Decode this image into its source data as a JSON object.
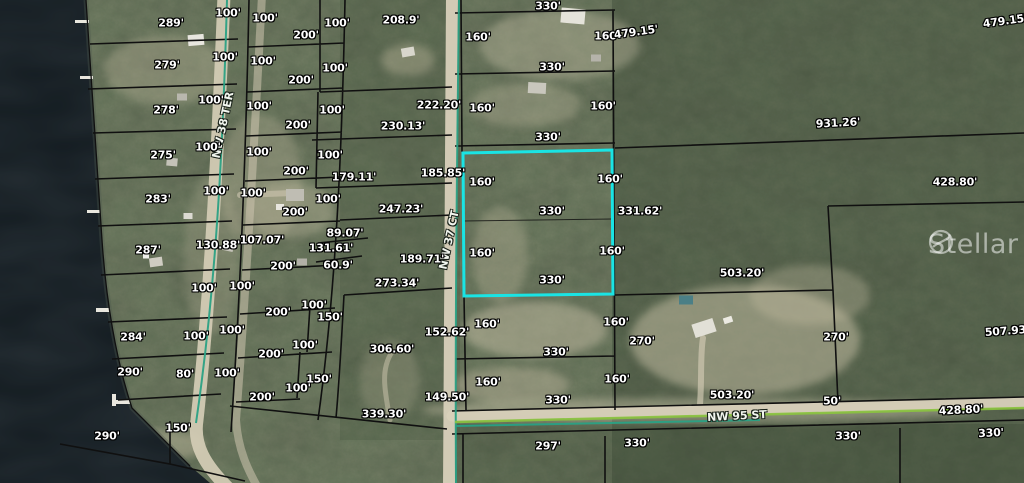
{
  "map": {
    "watermark": {
      "text": "Stellar MLS"
    },
    "subject_parcel": {
      "outline_color": "#1ae4e4",
      "frontage": "330'",
      "depth": "160'"
    },
    "colors": {
      "parcel_line": "#101010",
      "road_boundary_teal": "#2aa184",
      "street_line_green": "#8bc43f",
      "water": "#131b20",
      "dirt_road": "#d8d0ba",
      "highlight": "#1ae4e4"
    },
    "roads": [
      {
        "name": "NW 38 TER"
      },
      {
        "name": "NW 37 CT"
      },
      {
        "name": "NW 95 ST"
      }
    ],
    "road_labels": [
      {
        "t": "NW 38 TER",
        "x": 223,
        "y": 125,
        "r": -78
      },
      {
        "t": "NW 37 CT",
        "x": 449,
        "y": 240,
        "r": -78
      },
      {
        "t": "NW 95 ST",
        "x": 737,
        "y": 416,
        "r": -3
      }
    ],
    "dimension_labels": [
      {
        "t": "289'",
        "x": 171,
        "y": 23
      },
      {
        "t": "100'",
        "x": 228,
        "y": 13
      },
      {
        "t": "100'",
        "x": 265,
        "y": 18
      },
      {
        "t": "100'",
        "x": 337,
        "y": 23
      },
      {
        "t": "200'",
        "x": 306,
        "y": 35
      },
      {
        "t": "208.9'",
        "x": 401,
        "y": 20
      },
      {
        "t": "330'",
        "x": 548,
        "y": 6
      },
      {
        "t": "160'",
        "x": 478,
        "y": 37
      },
      {
        "t": "160'",
        "x": 607,
        "y": 36
      },
      {
        "t": "479.15'",
        "x": 636,
        "y": 32,
        "r": -8
      },
      {
        "t": "479.15'",
        "x": 1005,
        "y": 21,
        "r": -8
      },
      {
        "t": "279'",
        "x": 167,
        "y": 65
      },
      {
        "t": "100'",
        "x": 225,
        "y": 57
      },
      {
        "t": "100'",
        "x": 263,
        "y": 61
      },
      {
        "t": "100'",
        "x": 335,
        "y": 68
      },
      {
        "t": "200'",
        "x": 301,
        "y": 80
      },
      {
        "t": "330'",
        "x": 552,
        "y": 67
      },
      {
        "t": "278'",
        "x": 166,
        "y": 110
      },
      {
        "t": "100'",
        "x": 211,
        "y": 100
      },
      {
        "t": "100'",
        "x": 259,
        "y": 106
      },
      {
        "t": "100'",
        "x": 332,
        "y": 110
      },
      {
        "t": "200'",
        "x": 298,
        "y": 125
      },
      {
        "t": "222.20'",
        "x": 439,
        "y": 105
      },
      {
        "t": "230.13'",
        "x": 403,
        "y": 126
      },
      {
        "t": "160'",
        "x": 482,
        "y": 108
      },
      {
        "t": "160'",
        "x": 603,
        "y": 106
      },
      {
        "t": "330'",
        "x": 548,
        "y": 137
      },
      {
        "t": "931.26'",
        "x": 838,
        "y": 123,
        "r": -3
      },
      {
        "t": "275'",
        "x": 163,
        "y": 155
      },
      {
        "t": "100'",
        "x": 208,
        "y": 147
      },
      {
        "t": "100'",
        "x": 259,
        "y": 152
      },
      {
        "t": "100'",
        "x": 330,
        "y": 155
      },
      {
        "t": "200'",
        "x": 296,
        "y": 171
      },
      {
        "t": "179.11'",
        "x": 354,
        "y": 177
      },
      {
        "t": "185.85'",
        "x": 443,
        "y": 173
      },
      {
        "t": "160'",
        "x": 482,
        "y": 182
      },
      {
        "t": "160'",
        "x": 610,
        "y": 179
      },
      {
        "t": "283'",
        "x": 158,
        "y": 199
      },
      {
        "t": "100'",
        "x": 216,
        "y": 191
      },
      {
        "t": "100'",
        "x": 253,
        "y": 193
      },
      {
        "t": "100'",
        "x": 328,
        "y": 199
      },
      {
        "t": "200'",
        "x": 295,
        "y": 212
      },
      {
        "t": "247.23'",
        "x": 401,
        "y": 209
      },
      {
        "t": "330'",
        "x": 552,
        "y": 211
      },
      {
        "t": "331.62'",
        "x": 640,
        "y": 211
      },
      {
        "t": "428.80'",
        "x": 955,
        "y": 182
      },
      {
        "t": "287'",
        "x": 148,
        "y": 250
      },
      {
        "t": "130.88'",
        "x": 218,
        "y": 245
      },
      {
        "t": "107.07'",
        "x": 262,
        "y": 240
      },
      {
        "t": "89.07'",
        "x": 345,
        "y": 233
      },
      {
        "t": "131.61'",
        "x": 331,
        "y": 248
      },
      {
        "t": "60.9'",
        "x": 338,
        "y": 265
      },
      {
        "t": "200'",
        "x": 283,
        "y": 266
      },
      {
        "t": "189.71'",
        "x": 422,
        "y": 259
      },
      {
        "t": "160'",
        "x": 482,
        "y": 253
      },
      {
        "t": "160'",
        "x": 612,
        "y": 251
      },
      {
        "t": "330'",
        "x": 552,
        "y": 280
      },
      {
        "t": "503.20'",
        "x": 742,
        "y": 273
      },
      {
        "t": "273.34'",
        "x": 397,
        "y": 283
      },
      {
        "t": "100'",
        "x": 242,
        "y": 286
      },
      {
        "t": "100'",
        "x": 204,
        "y": 288
      },
      {
        "t": "284'",
        "x": 133,
        "y": 337
      },
      {
        "t": "100'",
        "x": 196,
        "y": 336
      },
      {
        "t": "100'",
        "x": 232,
        "y": 330
      },
      {
        "t": "200'",
        "x": 278,
        "y": 312
      },
      {
        "t": "100'",
        "x": 314,
        "y": 305
      },
      {
        "t": "150'",
        "x": 330,
        "y": 317
      },
      {
        "t": "306.60'",
        "x": 392,
        "y": 349
      },
      {
        "t": "152.62'",
        "x": 447,
        "y": 332
      },
      {
        "t": "160'",
        "x": 487,
        "y": 324
      },
      {
        "t": "160'",
        "x": 616,
        "y": 322
      },
      {
        "t": "270'",
        "x": 642,
        "y": 341
      },
      {
        "t": "270'",
        "x": 836,
        "y": 337
      },
      {
        "t": "507.93'",
        "x": 1007,
        "y": 331,
        "r": -4
      },
      {
        "t": "330'",
        "x": 556,
        "y": 352
      },
      {
        "t": "290'",
        "x": 130,
        "y": 372
      },
      {
        "t": "80'",
        "x": 185,
        "y": 374
      },
      {
        "t": "100'",
        "x": 227,
        "y": 373
      },
      {
        "t": "200'",
        "x": 271,
        "y": 354
      },
      {
        "t": "100'",
        "x": 305,
        "y": 345
      },
      {
        "t": "150'",
        "x": 319,
        "y": 379
      },
      {
        "t": "100'",
        "x": 298,
        "y": 388
      },
      {
        "t": "200'",
        "x": 262,
        "y": 397
      },
      {
        "t": "160'",
        "x": 488,
        "y": 382
      },
      {
        "t": "160'",
        "x": 617,
        "y": 379
      },
      {
        "t": "503.20'",
        "x": 732,
        "y": 395
      },
      {
        "t": "50'",
        "x": 832,
        "y": 401
      },
      {
        "t": "330'",
        "x": 558,
        "y": 400
      },
      {
        "t": "428.80'",
        "x": 961,
        "y": 410,
        "r": -3
      },
      {
        "t": "339.30'",
        "x": 384,
        "y": 414
      },
      {
        "t": "149.50'",
        "x": 447,
        "y": 397
      },
      {
        "t": "150'",
        "x": 178,
        "y": 428
      },
      {
        "t": "290'",
        "x": 107,
        "y": 436
      },
      {
        "t": "297'",
        "x": 548,
        "y": 446
      },
      {
        "t": "330'",
        "x": 637,
        "y": 443
      },
      {
        "t": "330'",
        "x": 848,
        "y": 436
      },
      {
        "t": "330'",
        "x": 991,
        "y": 433,
        "r": -3
      }
    ]
  }
}
